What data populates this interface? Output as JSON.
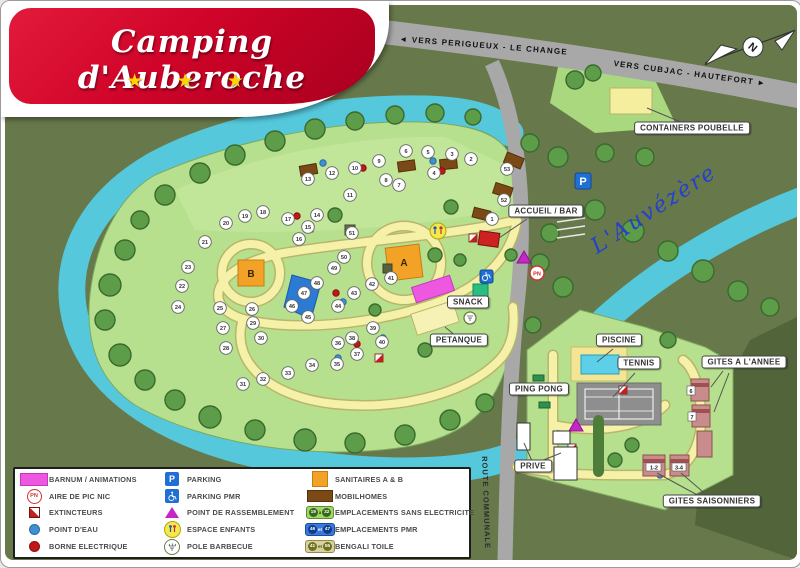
{
  "logo": {
    "title": "Camping d'Auberoche",
    "stars": "★ ★ ★"
  },
  "compass": {
    "north_label": "N"
  },
  "roads": {
    "main_west": "◄  VERS PERIGUEUX   -   LE CHANGE",
    "main_east": "VERS CUBJAC   -   HAUTEFORT  ►",
    "communal": "ROUTE COMMUNALE"
  },
  "river": {
    "name": "L'Auvézère"
  },
  "map_labels": {
    "containers": "CONTAINERS POUBELLE",
    "accueil": "ACCUEIL / BAR",
    "snack": "SNACK",
    "petanque": "PETANQUE",
    "piscine": "PISCINE",
    "tennis": "TENNIS",
    "ping_pong": "PING PONG",
    "gites_annee": "GITES A L'ANNEE",
    "gites_saisonniers": "GITES SAISONNIERS",
    "prive": "PRIVE",
    "sanitaire_a": "A",
    "sanitaire_b": "B",
    "parking_p": "P",
    "picnic_pn": "PN",
    "gite_6": "6",
    "gite_7": "7",
    "gite_1_2": "1-2",
    "gite_3_4": "3-4"
  },
  "pitches": [
    {
      "n": 1,
      "x": 487,
      "y": 214
    },
    {
      "n": 2,
      "x": 466,
      "y": 154
    },
    {
      "n": 3,
      "x": 447,
      "y": 149
    },
    {
      "n": 4,
      "x": 429,
      "y": 168
    },
    {
      "n": 5,
      "x": 423,
      "y": 147
    },
    {
      "n": 6,
      "x": 401,
      "y": 146
    },
    {
      "n": 7,
      "x": 394,
      "y": 180
    },
    {
      "n": 8,
      "x": 381,
      "y": 175
    },
    {
      "n": 9,
      "x": 374,
      "y": 156
    },
    {
      "n": 10,
      "x": 350,
      "y": 163
    },
    {
      "n": 11,
      "x": 345,
      "y": 190
    },
    {
      "n": 12,
      "x": 327,
      "y": 168
    },
    {
      "n": 13,
      "x": 303,
      "y": 174
    },
    {
      "n": 14,
      "x": 312,
      "y": 210
    },
    {
      "n": 15,
      "x": 303,
      "y": 222
    },
    {
      "n": 16,
      "x": 294,
      "y": 234
    },
    {
      "n": 17,
      "x": 283,
      "y": 214
    },
    {
      "n": 18,
      "x": 258,
      "y": 207
    },
    {
      "n": 19,
      "x": 240,
      "y": 211
    },
    {
      "n": 20,
      "x": 221,
      "y": 218
    },
    {
      "n": 21,
      "x": 200,
      "y": 237
    },
    {
      "n": 22,
      "x": 177,
      "y": 281
    },
    {
      "n": 23,
      "x": 183,
      "y": 262
    },
    {
      "n": 24,
      "x": 173,
      "y": 302
    },
    {
      "n": 25,
      "x": 215,
      "y": 303
    },
    {
      "n": 26,
      "x": 247,
      "y": 304
    },
    {
      "n": 27,
      "x": 218,
      "y": 323
    },
    {
      "n": 28,
      "x": 221,
      "y": 343
    },
    {
      "n": 29,
      "x": 248,
      "y": 318
    },
    {
      "n": 30,
      "x": 256,
      "y": 333
    },
    {
      "n": 31,
      "x": 238,
      "y": 379
    },
    {
      "n": 32,
      "x": 258,
      "y": 374
    },
    {
      "n": 33,
      "x": 283,
      "y": 368
    },
    {
      "n": 34,
      "x": 307,
      "y": 360
    },
    {
      "n": 35,
      "x": 332,
      "y": 359
    },
    {
      "n": 36,
      "x": 333,
      "y": 338
    },
    {
      "n": 37,
      "x": 352,
      "y": 349
    },
    {
      "n": 38,
      "x": 347,
      "y": 333
    },
    {
      "n": 39,
      "x": 368,
      "y": 323
    },
    {
      "n": 40,
      "x": 377,
      "y": 337
    },
    {
      "n": 41,
      "x": 386,
      "y": 273
    },
    {
      "n": 42,
      "x": 367,
      "y": 279
    },
    {
      "n": 43,
      "x": 349,
      "y": 288
    },
    {
      "n": 44,
      "x": 333,
      "y": 301
    },
    {
      "n": 45,
      "x": 303,
      "y": 312
    },
    {
      "n": 46,
      "x": 287,
      "y": 301
    },
    {
      "n": 47,
      "x": 299,
      "y": 288
    },
    {
      "n": 48,
      "x": 312,
      "y": 278
    },
    {
      "n": 49,
      "x": 329,
      "y": 263
    },
    {
      "n": 50,
      "x": 339,
      "y": 252
    },
    {
      "n": 51,
      "x": 347,
      "y": 228
    },
    {
      "n": 52,
      "x": 499,
      "y": 195
    },
    {
      "n": 53,
      "x": 502,
      "y": 164
    }
  ],
  "legend": {
    "columns": [
      {
        "items": [
          {
            "icon": "barnum",
            "label": "BARNUM / ANIMATIONS"
          },
          {
            "icon": "picnic",
            "label": "AIRE DE PIC NIC",
            "icon_text": "PN"
          },
          {
            "icon": "extinguisher",
            "label": "EXTINCTEURS"
          },
          {
            "icon": "water",
            "label": "POINT D'EAU"
          },
          {
            "icon": "electric",
            "label": "BORNE ELECTRIQUE"
          }
        ]
      },
      {
        "items": [
          {
            "icon": "parking",
            "label": "PARKING",
            "icon_text": "P"
          },
          {
            "icon": "parking-pmr",
            "label": "PARKING PMR"
          },
          {
            "icon": "assembly",
            "label": "POINT DE RASSEMBLEMENT"
          },
          {
            "icon": "kids",
            "label": "ESPACE ENFANTS"
          },
          {
            "icon": "bbq",
            "label": "POLE BARBECUE"
          }
        ]
      },
      {
        "items": [
          {
            "icon": "sanitaires",
            "label": "SANITAIRES A & B"
          },
          {
            "icon": "mobilhome",
            "label": "MOBILHOMES"
          },
          {
            "icon": "badge-green",
            "label": "EMPLACEMENTS SANS ELECTRICITE",
            "badge": [
              "19",
              "à",
              "32"
            ]
          },
          {
            "icon": "badge-blue",
            "label": "EMPLACEMENTS PMR",
            "badge": [
              "46",
              "et",
              "47"
            ]
          },
          {
            "icon": "badge-olive",
            "label": "BENGALI TOILE",
            "badge": [
              "41",
              "et",
              "55"
            ]
          }
        ]
      }
    ]
  },
  "colors": {
    "background_forest": "#67794b",
    "camp_area": "#b6e08e",
    "river": "#55c8dc",
    "road": "#a8a8a8",
    "path": "#f6f1a8",
    "logo_red": "#cf0428",
    "star_gold": "#ffd400",
    "sanitaires_orange": "#f2a227",
    "mobilhome_brown": "#7b4916",
    "barnum_pink": "#ee58e0",
    "parking_blue": "#1f6fd4"
  }
}
